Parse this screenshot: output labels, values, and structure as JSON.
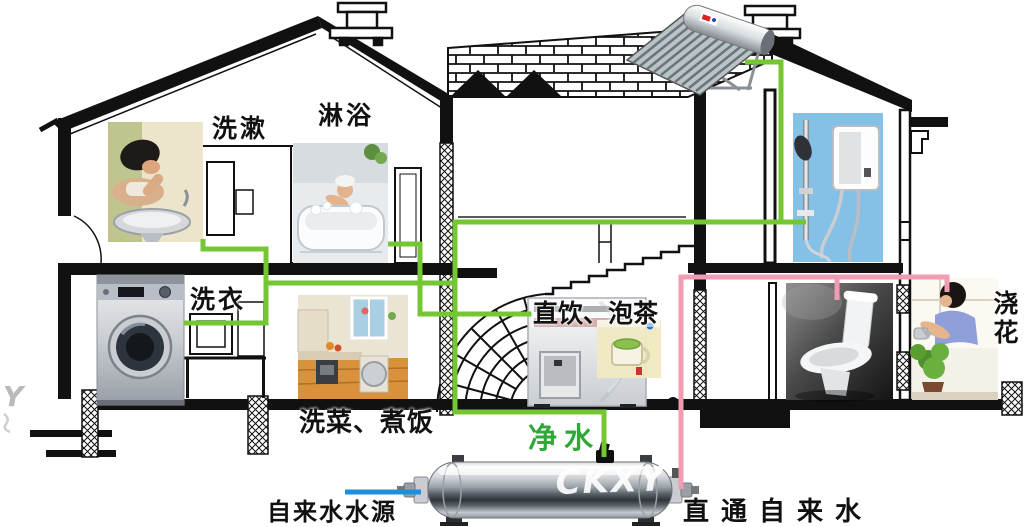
{
  "labels": {
    "wash_up": "洗漱",
    "shower": "淋浴",
    "laundry": "洗衣",
    "kitchen": "洗菜、煮饭",
    "drinking_tea": "直饮、泡茶",
    "purified_water": "净水",
    "tap_water_source": "自来水水源",
    "direct_tap_water": "直通自来水",
    "watering_flowers": "浇花"
  },
  "watermark": {
    "main": "CKXY",
    "edge": "Y"
  },
  "colors": {
    "purified_pipe_green": "#74c733",
    "tap_pipe_pink": "#f09cb2",
    "source_line_blue": "#1f8fd8",
    "purified_label_green": "#2fa838",
    "heater_wall_blue": "#85c0e6"
  }
}
